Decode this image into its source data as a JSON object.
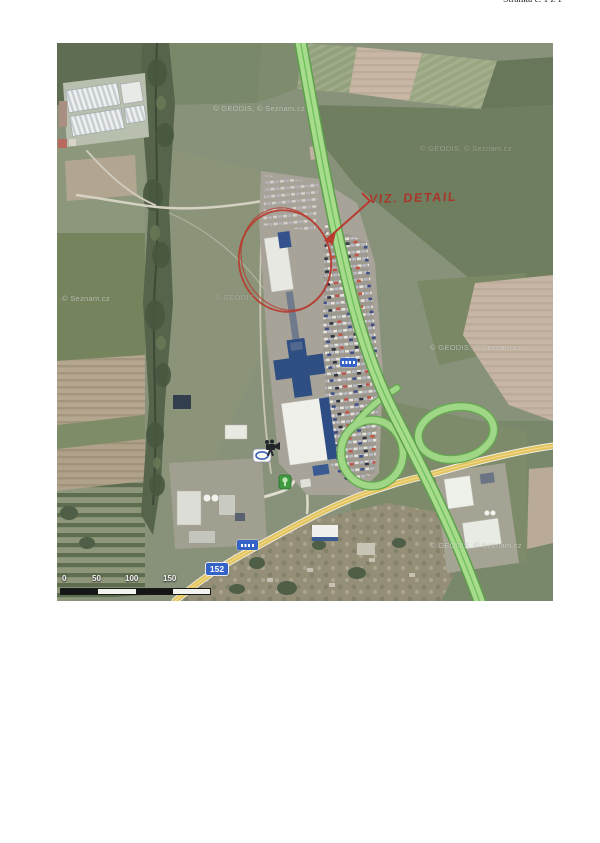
{
  "page": {
    "header_text": "Stránka č. 1 z 1"
  },
  "map": {
    "annotation_label": "VIZ. DETAIL",
    "road_badge": "152",
    "watermarks": {
      "full1": "© GEODIS, © Seznam.cz",
      "full2": "© GEODIS, © Seznam.cz",
      "seznam": "© Seznam.cz",
      "geodis": "© GEODIS",
      "full3": "© GEODIS, © Seznam.cz",
      "full4": "© GEODIS, © Seznam.cz"
    },
    "scale": {
      "labels": [
        "0",
        "50",
        "100",
        "150"
      ]
    },
    "colors": {
      "highway_highlight": "#a6dc8c",
      "secondary_road": "#e5c55a",
      "annotation_red": "#b73b2f",
      "badge_blue": "#3562c6"
    }
  }
}
